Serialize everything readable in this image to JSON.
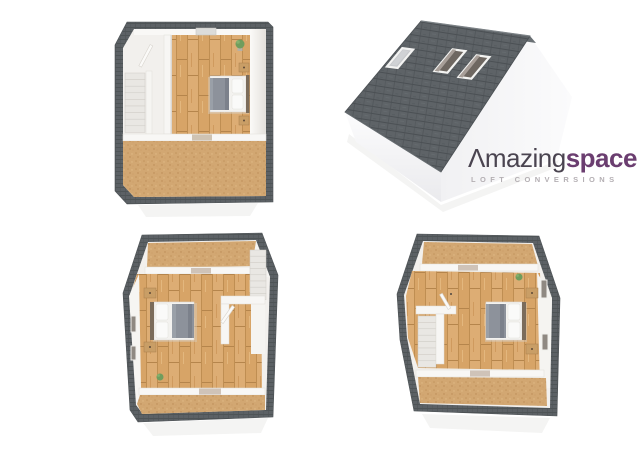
{
  "brand": {
    "name_part1": "Λmazing",
    "name_part2": "space",
    "tagline": "LOFT CONVERSIONS",
    "name_color_primary": "#4a4450",
    "name_color_accent": "#6b3e70",
    "tagline_color": "#b4afb3"
  },
  "palette": {
    "background": "#ffffff",
    "roof_slate": "#5d6367",
    "roof_slate_line": "#4b5054",
    "wall_white": "#f2f0ed",
    "wood_floor": "#d7a467",
    "carpet": "#d2a772",
    "bed_blanket": "#8d929b",
    "headboard": "#7b6c5b",
    "plant_green": "#6f9d5d"
  },
  "renders": [
    {
      "id": "floorplan-top",
      "name": "loft-floorplan-top-view"
    },
    {
      "id": "roof-exterior",
      "name": "roof-exterior-with-skylights"
    },
    {
      "id": "floorplan-angle-left",
      "name": "loft-floorplan-angled-view-stairs-right"
    },
    {
      "id": "floorplan-angle-right",
      "name": "loft-floorplan-angled-view-stairs-left"
    }
  ]
}
